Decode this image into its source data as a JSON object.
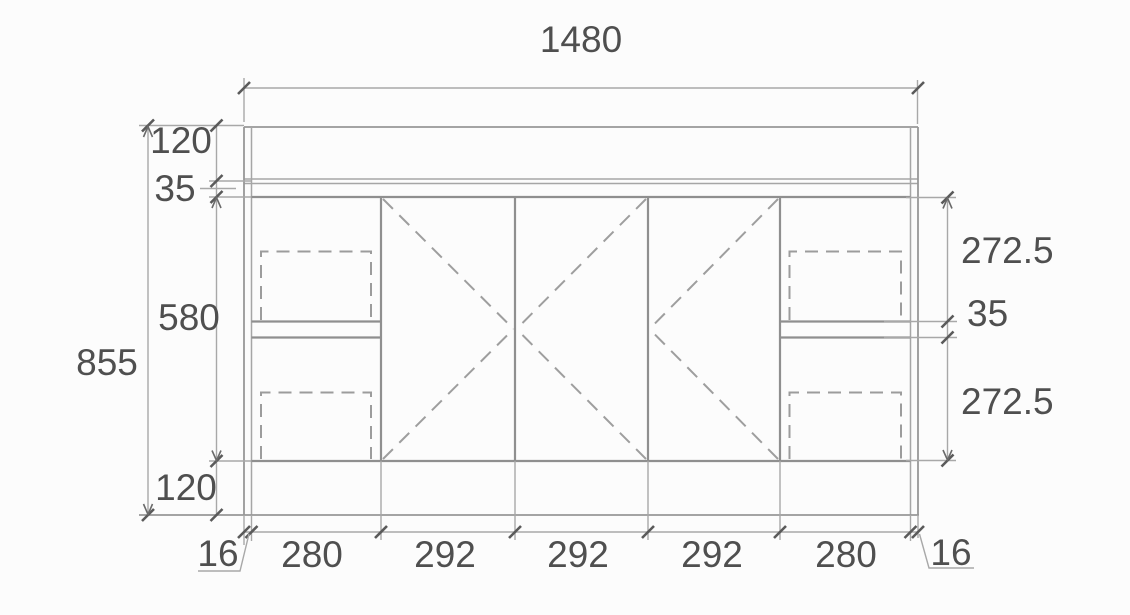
{
  "drawing": {
    "type": "cabinet-front-elevation",
    "units_shown": "none (numeric only)",
    "dims": {
      "total_width": "1480",
      "total_height": "855",
      "left": {
        "top_band": "120",
        "gap": "35",
        "door_region": "580",
        "plinth": "120",
        "side_thickness": "16"
      },
      "right": {
        "upper": "272.5",
        "gap": "35",
        "lower": "272.5",
        "side_thickness": "16"
      },
      "bottom": {
        "left_drawer": "280",
        "door_1": "292",
        "door_2": "292",
        "door_3": "292",
        "right_drawer": "280"
      }
    },
    "colors": {
      "background": "#fcfcfc",
      "line": "#979797",
      "dashed_line": "#9c9c9c",
      "dimension_line": "#a8a8a8",
      "tick": "#5a5a5a",
      "text": "#4f4f4f"
    }
  }
}
